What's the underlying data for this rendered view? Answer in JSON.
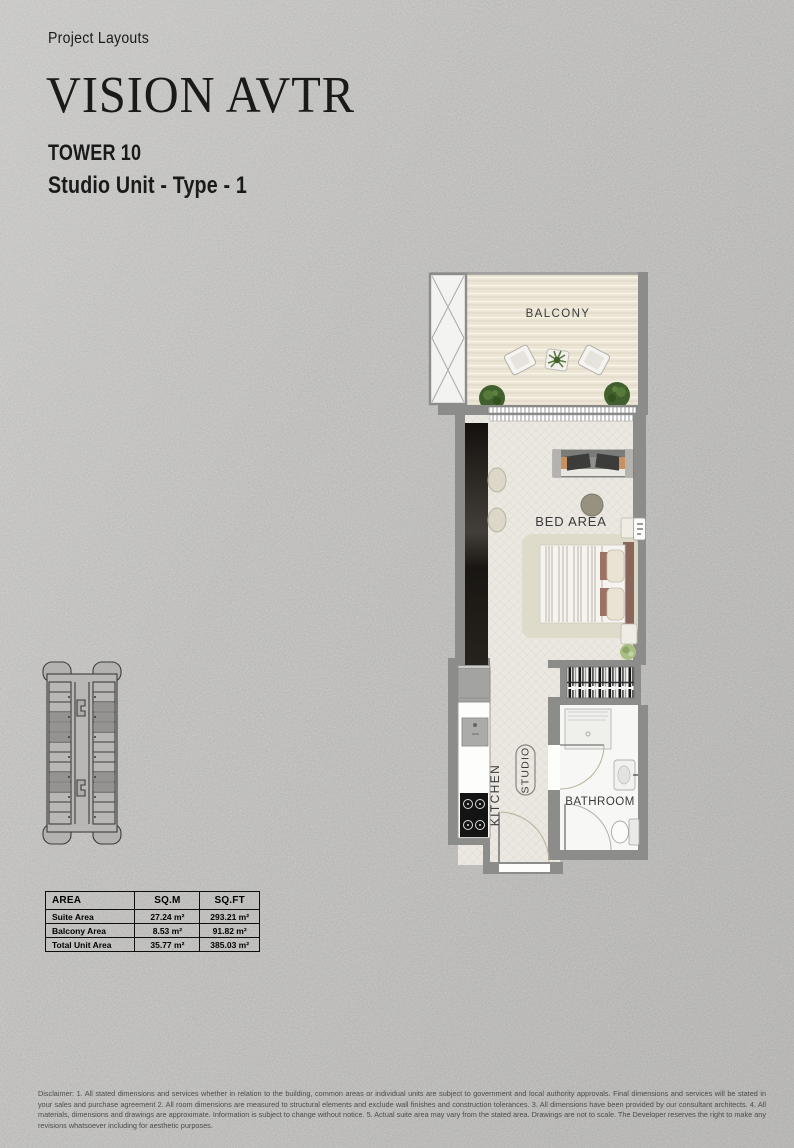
{
  "header": {
    "eyebrow": "Project Layouts",
    "title": "VISION AVTR",
    "tower": "TOWER 10",
    "unit_type": "Studio Unit - Type - 1"
  },
  "floorplan": {
    "labels": {
      "balcony": "BALCONY",
      "bed_area": "BED AREA",
      "kitchen": "KITCHEN",
      "studio": "STUDIO",
      "bathroom": "BATHROOM"
    }
  },
  "area_table": {
    "headers": [
      "AREA",
      "SQ.M",
      "SQ.FT"
    ],
    "rows": [
      {
        "label": "Suite Area",
        "sqm": "27.24 m²",
        "sqft": "293.21 m²"
      },
      {
        "label": "Balcony Area",
        "sqm": "8.53 m²",
        "sqft": "91.82 m²"
      },
      {
        "label": "Total Unit Area",
        "sqm": "35.77 m²",
        "sqft": "385.03 m²"
      }
    ]
  },
  "disclaimer": "Disclaimer: 1. All stated dimensions and services whether in relation to the building, common areas or individual units are subject to government and local authority approvals. Final dimensions and services will be stated in your sales and purchase agreement 2. All room dimensions are measured to structural elements and exclude wall finishes and construction tolerances. 3. All dimensions have been provided by our consultant architects. 4. All materials, dimensions and drawings are approximate. Information is subject to change without notice. 5. Actual suite area may vary from the stated area. Drawings are not to scale. The Developer reserves the right to make any revisions whatsoever including for aesthetic purposes.",
  "colors": {
    "background": "#bcbbb9",
    "wall": "#8c8c8b",
    "balcony_floor": "#ece5d5",
    "interior_floor": "#ebe8e2",
    "dark_cabinet": "#201d18",
    "headboard": "#8a655c",
    "plant_green": "#486331",
    "table_border": "#0d0d0d"
  }
}
